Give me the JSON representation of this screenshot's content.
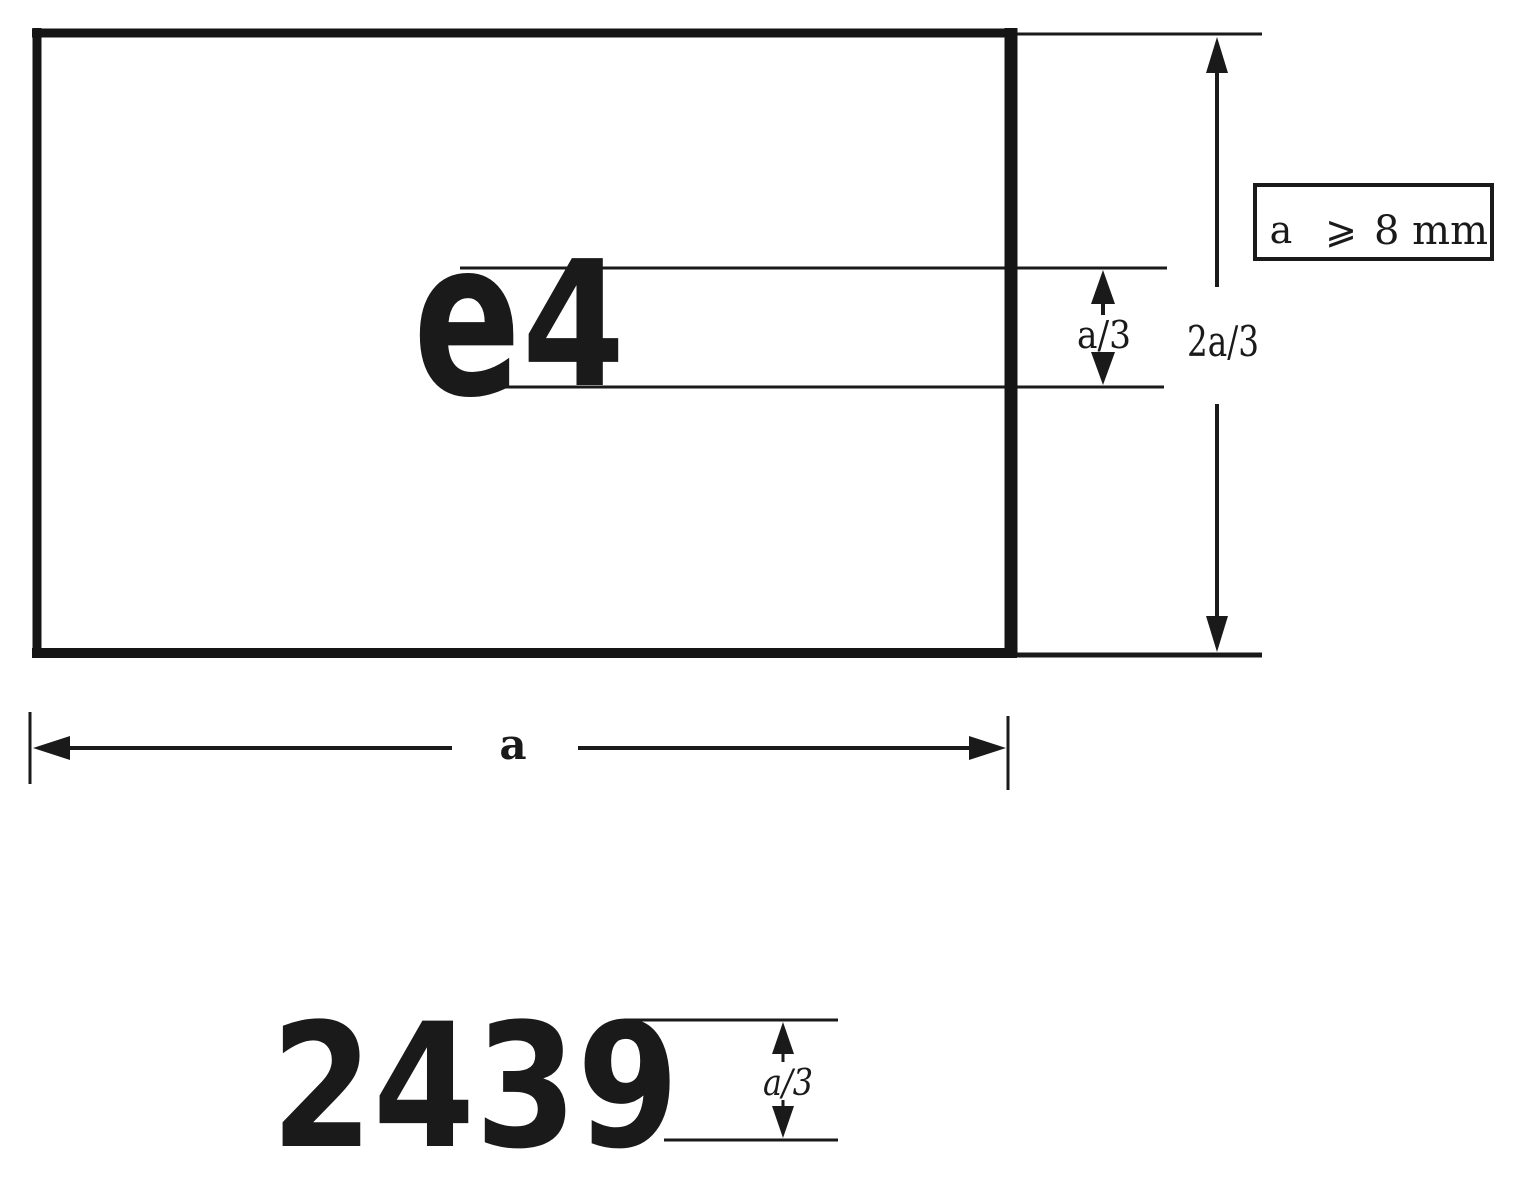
{
  "colors": {
    "ink": "#1a1a1a",
    "paper": "#ffffff"
  },
  "mark": {
    "letter": "e",
    "country_number": "4",
    "approval_number": "2439"
  },
  "dims": {
    "char_height": "a/3",
    "band_height": "2a/3",
    "width": "a",
    "number_height": "a/3"
  },
  "note": {
    "var": "a",
    "relation": "⩾",
    "value": "8 mm"
  }
}
